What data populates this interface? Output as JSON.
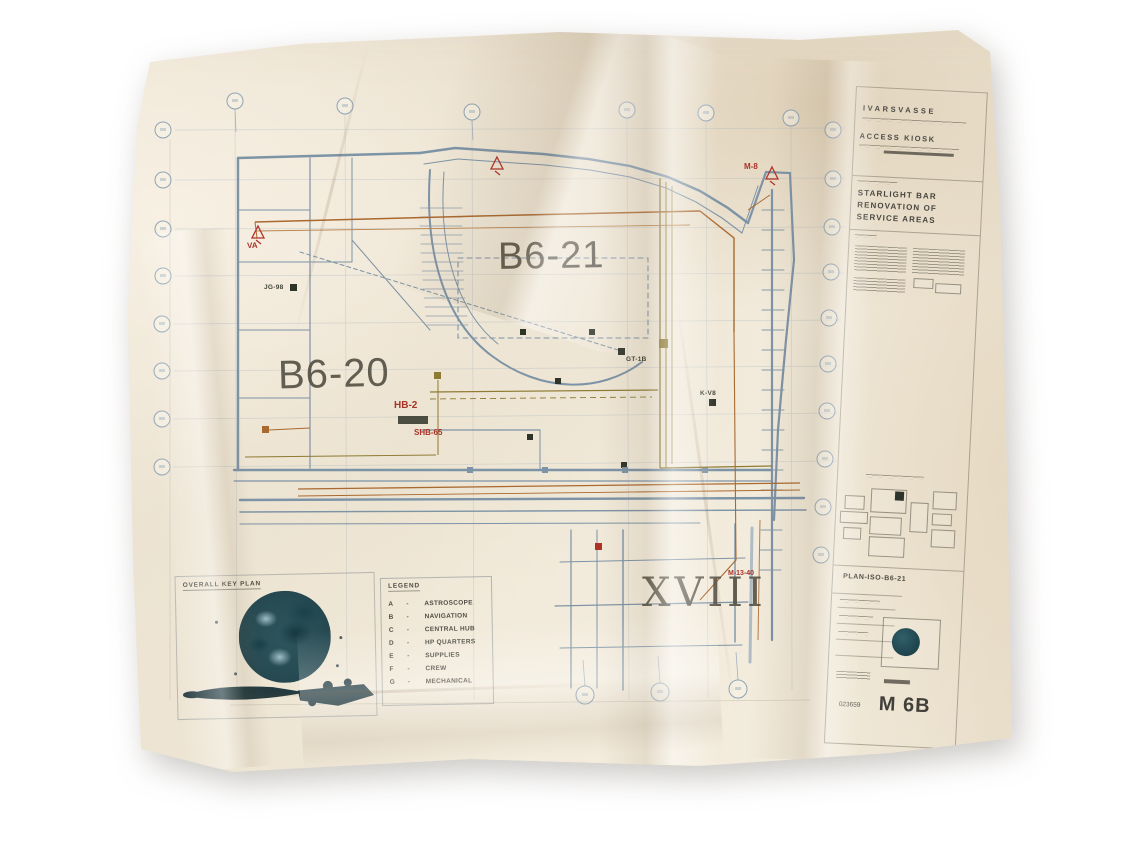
{
  "colors": {
    "paper": "#ece3d2",
    "plan_line": "#7d93a6",
    "accent_orange": "#a9692f",
    "accent_olive": "#8d7a33",
    "accent_red": "#b03227",
    "stamp_teal": "#265058",
    "ink": "#4e4a40"
  },
  "plan": {
    "zone_left": "B6-20",
    "zone_center": "B6-21",
    "section_numeral": "XVIII"
  },
  "markers": {
    "valve_left": "VA",
    "valve_right": "M-8",
    "hb": "HB-2",
    "shb": "SHB-65",
    "m1340": "M-13-40",
    "jg": "JG-98",
    "gt": "GT-1B",
    "kv": "K-V8"
  },
  "title_block": {
    "firm_name": "IVARSVASSE",
    "firm_dept": "ACCESS KIOSK",
    "project_line1": "STARLIGHT BAR",
    "project_line2": "RENOVATION OF",
    "project_line3": "SERVICE AREAS",
    "plan_ref": "PLAN-ISO-B6-21",
    "stamp_number": "023659",
    "sheet_number": "M 6B"
  },
  "key_plan": {
    "title": "OVERALL KEY PLAN"
  },
  "legend": {
    "title": "LEGEND",
    "separator": "-",
    "items": [
      {
        "key": "A",
        "label": "ASTROSCOPE"
      },
      {
        "key": "B",
        "label": "NAVIGATION"
      },
      {
        "key": "C",
        "label": "CENTRAL HUB"
      },
      {
        "key": "D",
        "label": "HP QUARTERS"
      },
      {
        "key": "E",
        "label": "SUPPLIES"
      },
      {
        "key": "F",
        "label": "CREW"
      },
      {
        "key": "G",
        "label": "MECHANICAL"
      }
    ]
  }
}
